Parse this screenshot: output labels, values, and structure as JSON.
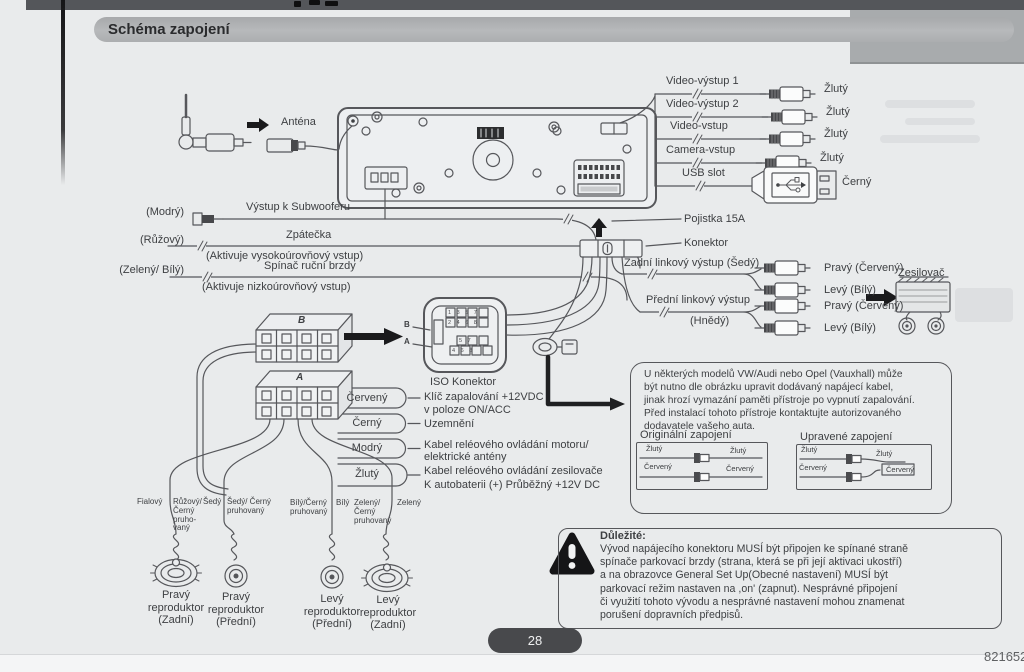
{
  "title": "Schéma zapojení",
  "antenna": {
    "label": "Anténa"
  },
  "video_rows": [
    {
      "label": "Video-výstup 1",
      "plug": "Žlutý"
    },
    {
      "label": "Video-výstup 2",
      "plug": "Žlutý"
    },
    {
      "label": "Video-vstup",
      "plug": "Žlutý"
    },
    {
      "label": "Camera-vstup",
      "plug": "Žlutý"
    },
    {
      "label": "USB slot",
      "plug": "Černý"
    }
  ],
  "left_rows": [
    {
      "wire": "(Modrý)",
      "label": "Výstup k Subwooferu",
      "sub": ""
    },
    {
      "wire": "(Růžový)",
      "label": "Zpátečka",
      "sub": "(Aktivuje vysokoúrovňový vstup)"
    },
    {
      "wire": "(Zelený/ Bílý)",
      "label": "Spínač ruční brzdy",
      "sub": "(Aktivuje nizkoúrovňový vstup)"
    }
  ],
  "power_block": {
    "fuse": "Pojistka 15A",
    "connector": "Konektor"
  },
  "line_out": {
    "rear": "Zadní linkový výstup (Šedý)",
    "front": "Přední linkový výstup",
    "front_color": "(Hnědý)",
    "rear_right": "Pravý (Červený)",
    "rear_left": "Levý (Bílý)",
    "front_right": "Pravý (Červený)",
    "front_left": "Levý (Bílý)",
    "amp": "Zesilovač"
  },
  "iso": {
    "label": "ISO Konektor",
    "b": "B",
    "a": "A",
    "block_b": "B",
    "block_a": "A",
    "pins_top1": "1 3 5 7",
    "pins_top2": "2 4 6 8",
    "pins_bot1": "5 7",
    "pins_bot2": "4 6 8"
  },
  "power_wires": {
    "c1": "Červený",
    "c2": "Černý",
    "c3": "Modrý",
    "c4": "Žlutý",
    "d1": "Klíč zapalování +12VDC\nv poloze ON/ACC",
    "d2": "Uzemnění",
    "d3": "Kabel reléového ovládání motoru/\nelektrické antény",
    "d4": "Kabel reléového ovládání zesilovače",
    "d5": "K autobaterii (+) Průběžný +12V DC"
  },
  "vw_note": {
    "text": "U některých modelů VW/Audi nebo Opel (Vauxhall) může\nbýt nutno dle obrázku upravit dodávaný napájecí kabel,\njinak hrozí vymazání paměti přístroje po vypnutí zapalování.\nPřed instalací tohoto přístroje kontaktujte autorizovaného\ndodavatele vašeho auta.",
    "orig": "Originální zapojení",
    "mod": "Upravené zapojení",
    "y": "Žlutý",
    "r": "Červený"
  },
  "speakers": {
    "w1": "Fialový",
    "w2": "Růžový/\nČerný\npruho-\nvaný",
    "w3": "Šedý",
    "w4": "Šedý/ Černý\npruhovaný",
    "w5": "Bílý/Černý\npruhovaný",
    "w6": "Bílý",
    "w7": "Zelený/\nČerný\npruhovaný",
    "w8": "Zelený",
    "s1": "Pravý\nreproduktor\n(Zadní)",
    "s2": "Pravý\nreproduktor\n(Přední)",
    "s3": "Levý\nreproduktor\n(Přední)",
    "s4": "Levý\nreproduktor\n(Zadní)"
  },
  "important": {
    "title": "Důležité:",
    "text": "Vývod napájecího konektoru MUSÍ být připojen ke spínané straně\nspínače parkovací brzdy (strana, která se při její aktivaci ukostří)\na na obrazovce General Set Up(Obecné nastavení) MUSÍ být\nparkovací režim nastaven na ,on' (zapnut). Nesprávné připojení\nči využití tohoto vývodu a nesprávné nastavení mohou znamenat\nporušení dopravních předpisů."
  },
  "footer": {
    "page": "28",
    "doc": "821652"
  },
  "colors": {
    "paper": "#e9ebec",
    "bar": "#54565a",
    "ink": "#3e4043",
    "line": "#56575b"
  }
}
